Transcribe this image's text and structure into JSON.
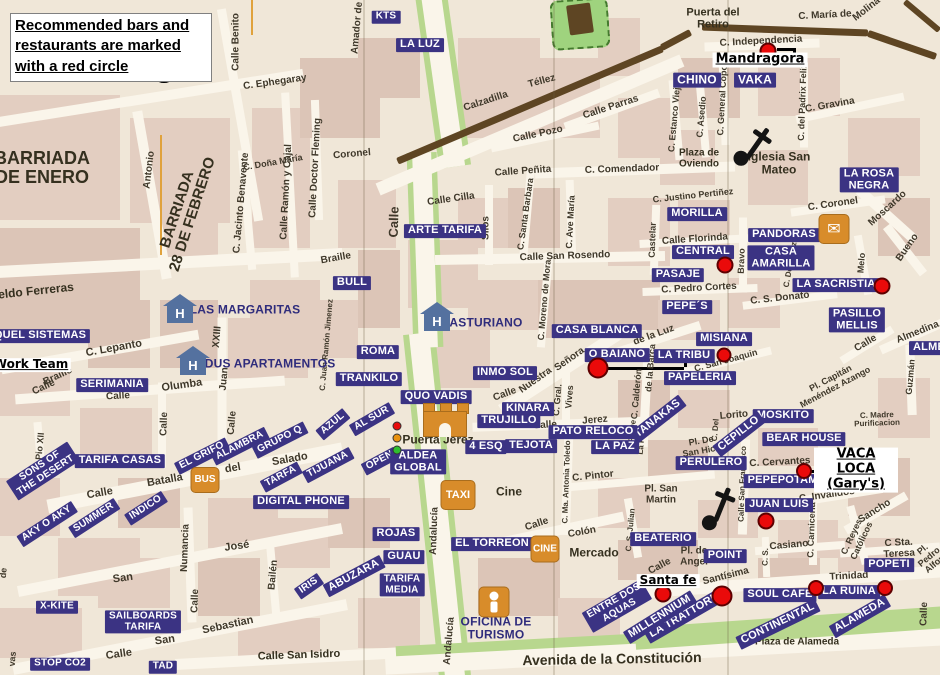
{
  "legend": {
    "line1": "Recommended bars and",
    "line2": "restaurants are marked",
    "line3": "with a red circle"
  },
  "colors": {
    "navy": "#3b3383",
    "red": "#ea0a0a",
    "orange": "#d88c2a",
    "wall": "#5e4523",
    "park": "#9fd37e",
    "road_green": "#b8d78e",
    "hotel_blue": "#54719f"
  },
  "shop_labels": [
    [
      "KTS",
      386,
      17,
      0,
      10
    ],
    [
      "LA LUZ",
      420,
      45,
      0,
      11
    ],
    [
      "ARTE TARIFA",
      445,
      231,
      0,
      11
    ],
    [
      "CHINO",
      697,
      80,
      0,
      12
    ],
    [
      "VAKA",
      755,
      80,
      0,
      12
    ],
    [
      "MORILLA",
      697,
      214,
      0,
      11
    ],
    [
      "PANDORAS",
      784,
      235,
      0,
      11
    ],
    [
      "CENTRAL",
      703,
      252,
      0,
      11
    ],
    [
      "CASA\nAMARILLA",
      781,
      258,
      0,
      11
    ],
    [
      "PASAJE",
      678,
      275,
      0,
      11
    ],
    [
      "LA ROSA\nNEGRA",
      869,
      180,
      0,
      11
    ],
    [
      "LA SACRISTIA",
      836,
      285,
      0,
      11
    ],
    [
      "PASILLO\nMELLIS",
      857,
      320,
      0,
      11
    ],
    [
      "PEPE´S",
      687,
      307,
      0,
      11
    ],
    [
      "CASA BLANCA",
      597,
      331,
      0,
      11
    ],
    [
      "O BAIANO",
      617,
      355,
      0,
      11
    ],
    [
      "LA TRIBU",
      684,
      356,
      0,
      11
    ],
    [
      "MISIANA",
      724,
      339,
      0,
      11
    ],
    [
      "PAPELERIA",
      700,
      378,
      0,
      11
    ],
    [
      "TANAKAS",
      658,
      419,
      -38,
      11
    ],
    [
      "MOSKITO",
      783,
      416,
      0,
      11
    ],
    [
      "BEAR HOUSE",
      804,
      439,
      0,
      11
    ],
    [
      "CEPILLO",
      739,
      434,
      -38,
      11
    ],
    [
      "PERULERO",
      711,
      463,
      0,
      11
    ],
    [
      "PEPEPOTAMO",
      787,
      481,
      0,
      11
    ],
    [
      "JUAN LUIS",
      779,
      505,
      0,
      11
    ],
    [
      "BEATERIO",
      663,
      539,
      0,
      11
    ],
    [
      "POINT",
      725,
      556,
      0,
      11
    ],
    [
      "POPETI",
      889,
      565,
      0,
      11
    ],
    [
      "SOUL CAFE",
      780,
      595,
      0,
      11
    ],
    [
      "LA RUINA",
      849,
      592,
      0,
      11
    ],
    [
      "ALAMEDA",
      860,
      616,
      -30,
      11
    ],
    [
      "CONTINENTAL",
      778,
      624,
      -26,
      11
    ],
    [
      "LA TRATTORIA",
      686,
      615,
      -30,
      11
    ],
    [
      "MILLENNIUM",
      660,
      617,
      -32,
      11
    ],
    [
      "ENTRE DOS\nAQUAS",
      617,
      606,
      -30,
      10
    ],
    [
      "EL TORREON",
      492,
      544,
      0,
      11
    ],
    [
      "ROJAS",
      396,
      534,
      0,
      11
    ],
    [
      "GUAU",
      404,
      557,
      0,
      11
    ],
    [
      "ABUZARA",
      354,
      576,
      -28,
      11
    ],
    [
      "TARIFA\nMEDIA",
      402,
      585,
      0,
      10
    ],
    [
      "IRIS",
      309,
      586,
      -35,
      10
    ],
    [
      "X-KITE",
      57,
      607,
      0,
      10
    ],
    [
      "SAILBOARDS\nTARIFA",
      143,
      622,
      0,
      10
    ],
    [
      "STOP CO2",
      60,
      664,
      0,
      10
    ],
    [
      "TAD",
      163,
      667,
      0,
      10
    ],
    [
      "INMO SOL",
      505,
      373,
      0,
      11
    ],
    [
      "KINARA",
      528,
      409,
      0,
      11
    ],
    [
      "TRUJILLO",
      509,
      421,
      0,
      11
    ],
    [
      "4 ESQ",
      486,
      447,
      0,
      11
    ],
    [
      "TEJOTA",
      531,
      446,
      0,
      11
    ],
    [
      "PATO RELOCO",
      593,
      432,
      0,
      11
    ],
    [
      "LA PAZ",
      615,
      447,
      0,
      11
    ],
    [
      "QUO VADIS",
      436,
      397,
      0,
      11
    ],
    [
      "ROMA",
      378,
      352,
      0,
      11
    ],
    [
      "TRANKILO",
      369,
      379,
      0,
      11
    ],
    [
      "BULL",
      352,
      283,
      0,
      11
    ],
    [
      "SERIMANIA",
      112,
      385,
      0,
      11
    ],
    [
      "QUEL SISTEMAS",
      40,
      336,
      0,
      11
    ],
    [
      "TARIFA CASAS",
      120,
      461,
      0,
      11
    ],
    [
      "SONS OF\nTHE DESERT",
      43,
      471,
      -33,
      10
    ],
    [
      "AKY O AKY",
      47,
      524,
      -33,
      10
    ],
    [
      "SUMMER",
      94,
      518,
      -33,
      10
    ],
    [
      "INDICO",
      146,
      508,
      -33,
      10
    ],
    [
      "EL GRIFO",
      202,
      456,
      -27,
      10
    ],
    [
      "ALAMBRA",
      240,
      446,
      -27,
      10
    ],
    [
      "GRUPO Q",
      280,
      440,
      -27,
      10
    ],
    [
      "AZUL",
      333,
      424,
      -40,
      10
    ],
    [
      "AL SUR",
      372,
      419,
      -30,
      10
    ],
    [
      "TIJUANA",
      328,
      465,
      -28,
      10
    ],
    [
      "OPEN",
      380,
      461,
      -28,
      10
    ],
    [
      "ALDEA\nGLOBAL",
      418,
      462,
      0,
      11
    ],
    [
      "DIGITAL PHONE",
      301,
      502,
      0,
      11
    ],
    [
      "TARFA",
      281,
      477,
      -28,
      10
    ],
    [
      "ALME",
      929,
      348,
      0,
      11
    ]
  ],
  "hotel_labels": [
    [
      "LAS MARGARITAS",
      245,
      310,
      0,
      12
    ],
    [
      "EDUS APARTAMENTOS",
      266,
      364,
      0,
      12
    ],
    [
      "ASTURIANO",
      486,
      323,
      0,
      12
    ],
    [
      "OFICINA DE\nTURISMO",
      496,
      628,
      0,
      12
    ]
  ],
  "area_labels": [
    [
      "BARRIADA\nDE ENERO",
      42,
      168,
      0,
      18
    ],
    [
      "BARRIADA\n28 DE FEBRERO",
      185,
      212,
      -72,
      15
    ],
    [
      "eldo Ferreras",
      36,
      291,
      -6,
      12
    ],
    [
      "Puerta del\nRetiro",
      713,
      19,
      0,
      11
    ],
    [
      "Plaza de\nOviendo",
      699,
      159,
      0,
      10
    ],
    [
      "Iglesia San\nMateo",
      779,
      163,
      0,
      12
    ],
    [
      "Puerta Jerez",
      438,
      440,
      0,
      12
    ],
    [
      "Cine",
      509,
      492,
      0,
      12
    ],
    [
      "Mercado",
      594,
      553,
      0,
      12
    ],
    [
      "Plaza de Alameda",
      797,
      643,
      0,
      10
    ],
    [
      "Avenida de la Constitución",
      612,
      659,
      -1,
      14
    ],
    [
      "Calle San Isidro",
      299,
      656,
      -2,
      11
    ]
  ],
  "street_labels": [
    [
      "Calle Benito",
      237,
      42,
      -90,
      10
    ],
    [
      "C. Ephegaray",
      275,
      83,
      -8,
      10
    ],
    [
      "Antonio",
      150,
      170,
      -83,
      10
    ],
    [
      "C. Jacinto Benavente",
      242,
      203,
      -85,
      10
    ],
    [
      "C. Doña María",
      273,
      163,
      -10,
      9
    ],
    [
      "Calle Ramón y Cajal",
      287,
      192,
      -87,
      10
    ],
    [
      "Calle Doctor Fleming",
      316,
      168,
      -87,
      10
    ],
    [
      "Coronel",
      352,
      155,
      -5,
      10
    ],
    [
      "Amador de",
      358,
      28,
      -85,
      10
    ],
    [
      "Calzadilla",
      486,
      102,
      -18,
      10
    ],
    [
      "Téllez",
      542,
      82,
      -15,
      10
    ],
    [
      "Calle Pozo",
      538,
      135,
      -12,
      10
    ],
    [
      "Calle Parras",
      611,
      108,
      -18,
      10
    ],
    [
      "Calle Peñita",
      523,
      172,
      -4,
      10
    ],
    [
      "C. Comendador",
      622,
      170,
      -2,
      10
    ],
    [
      "Calle Cilla",
      451,
      200,
      -8,
      10
    ],
    [
      "Silos",
      487,
      228,
      -90,
      10
    ],
    [
      "C. Santa Barbara",
      526,
      214,
      -82,
      9
    ],
    [
      "C. Ave María",
      571,
      222,
      -87,
      9
    ],
    [
      "Calle San Rosendo",
      565,
      257,
      -2,
      10
    ],
    [
      "C. Moreno de Mora",
      545,
      300,
      -85,
      9
    ],
    [
      "C. Justino Pertiñez",
      693,
      196,
      -6,
      9
    ],
    [
      "Calle Florinda",
      695,
      240,
      -4,
      10
    ],
    [
      "Castelar",
      653,
      240,
      -88,
      9
    ],
    [
      "Bravo",
      742,
      261,
      -88,
      9
    ],
    [
      "C. Pedro Cortes",
      699,
      289,
      -3,
      10
    ],
    [
      "C. S. Donato",
      780,
      299,
      -6,
      10
    ],
    [
      "C. Estanco Viejo",
      675,
      117,
      -85,
      9
    ],
    [
      "C. Asedio",
      702,
      117,
      -85,
      9
    ],
    [
      "C. General Copons",
      723,
      95,
      -87,
      9
    ],
    [
      "C. del Padrix Felix",
      803,
      102,
      -88,
      9
    ],
    [
      "C. Gravina",
      830,
      106,
      -10,
      10
    ],
    [
      "C. María de",
      825,
      16,
      -3,
      10
    ],
    [
      "Molina",
      867,
      10,
      -38,
      10
    ],
    [
      "C. Independencia",
      761,
      42,
      -3,
      10
    ],
    [
      "C. Coronel",
      833,
      205,
      -8,
      10
    ],
    [
      "Moscardo",
      888,
      209,
      -42,
      10
    ],
    [
      "Bueno",
      908,
      248,
      -55,
      10
    ],
    [
      "Melo",
      862,
      263,
      -85,
      9
    ],
    [
      "C. De los Azues",
      792,
      258,
      -80,
      8
    ],
    [
      "Almedina",
      918,
      333,
      -22,
      10
    ],
    [
      "Calle",
      866,
      344,
      -30,
      10
    ],
    [
      "Guzmán",
      911,
      377,
      -85,
      9
    ],
    [
      "Pl. Capitán\nMenéndez Azango",
      833,
      383,
      -28,
      9
    ],
    [
      "C. Madre Purificacion",
      877,
      420,
      -2,
      8
    ],
    [
      "de la Luz",
      654,
      336,
      -20,
      10
    ],
    [
      "Nuestra",
      536,
      381,
      -35,
      10
    ],
    [
      "Señora",
      570,
      360,
      -35,
      10
    ],
    [
      "C. Calderón",
      637,
      394,
      -85,
      9
    ],
    [
      "de la Barca",
      651,
      368,
      -85,
      9
    ],
    [
      "C. Gral.",
      558,
      400,
      -85,
      9
    ],
    [
      "Vives",
      570,
      397,
      -85,
      9
    ],
    [
      "Calle",
      505,
      395,
      -20,
      10
    ],
    [
      "Jerez",
      595,
      421,
      -5,
      10
    ],
    [
      "Calle",
      545,
      426,
      -3,
      10
    ],
    [
      "C. Del",
      716,
      430,
      -85,
      8
    ],
    [
      "Lorito",
      734,
      416,
      -5,
      10
    ],
    [
      "Pl. De\nSan Hicio",
      702,
      446,
      -10,
      9
    ],
    [
      "C. San Joaquin",
      726,
      361,
      -15,
      9
    ],
    [
      "C. Cervantes",
      780,
      463,
      -3,
      10
    ],
    [
      "C. Invalidos",
      827,
      496,
      -8,
      10
    ],
    [
      "Sancho",
      875,
      512,
      -32,
      10
    ],
    [
      "C. Carniceria",
      812,
      530,
      -88,
      9
    ],
    [
      "Casiano",
      789,
      546,
      -5,
      10
    ],
    [
      "C. Reyes",
      852,
      537,
      -65,
      9
    ],
    [
      "Católicos",
      862,
      541,
      -65,
      9
    ],
    [
      "C Sta. Teresa",
      899,
      549,
      -3,
      10
    ],
    [
      "Pl. Pedro Alfon",
      929,
      557,
      -40,
      9
    ],
    [
      "Trinidad",
      849,
      577,
      -3,
      10
    ],
    [
      "Santísima",
      726,
      577,
      -14,
      10
    ],
    [
      "Calle",
      660,
      567,
      -28,
      10
    ],
    [
      "Pl. de\nAngel",
      694,
      557,
      0,
      10
    ],
    [
      "Calle",
      925,
      614,
      -88,
      10
    ],
    [
      "Calle",
      537,
      525,
      -18,
      10
    ],
    [
      "Colón",
      582,
      533,
      -10,
      10
    ],
    [
      "C. Ma. Antonia Toledo",
      567,
      482,
      -88,
      8
    ],
    [
      "C. S. Julian",
      631,
      530,
      -85,
      8
    ],
    [
      "C. Pintor",
      593,
      477,
      -6,
      10
    ],
    [
      "Pl. San\nMartin",
      661,
      495,
      0,
      10
    ],
    [
      "Calle San Francisco",
      743,
      484,
      -88,
      8
    ],
    [
      "C. S.",
      766,
      557,
      -88,
      8
    ],
    [
      "Braille",
      336,
      259,
      -10,
      10
    ],
    [
      "Calle",
      394,
      222,
      -88,
      13
    ],
    [
      "Braille",
      58,
      377,
      -25,
      10
    ],
    [
      "Calle",
      44,
      388,
      -25,
      10
    ],
    [
      "C. Lepanto",
      114,
      349,
      -10,
      11
    ],
    [
      "Olumba",
      182,
      386,
      -8,
      11
    ],
    [
      "Calle",
      118,
      397,
      -3,
      10
    ],
    [
      "Calle",
      165,
      424,
      -88,
      10
    ],
    [
      "XXIII",
      218,
      337,
      -85,
      10
    ],
    [
      "Juan",
      225,
      379,
      -85,
      10
    ],
    [
      "Calle",
      233,
      423,
      -85,
      10
    ],
    [
      "C. Pio XII",
      40,
      452,
      -85,
      9
    ],
    [
      "Calle",
      100,
      494,
      -10,
      11
    ],
    [
      "Batalla",
      165,
      481,
      -10,
      11
    ],
    [
      "del",
      233,
      469,
      -10,
      11
    ],
    [
      "Salado",
      290,
      460,
      -10,
      11
    ],
    [
      "Numancia",
      186,
      548,
      -88,
      10
    ],
    [
      "Calle",
      196,
      601,
      -88,
      10
    ],
    [
      "José",
      237,
      547,
      -8,
      11
    ],
    [
      "San",
      123,
      579,
      -8,
      11
    ],
    [
      "Bailén",
      274,
      575,
      -85,
      10
    ],
    [
      "San",
      165,
      641,
      -8,
      11
    ],
    [
      "Sebastian",
      228,
      626,
      -12,
      11
    ],
    [
      "Calle",
      119,
      655,
      -8,
      11
    ],
    [
      "Andalucía",
      435,
      531,
      -88,
      10
    ],
    [
      "Andalucía",
      450,
      641,
      -85,
      10
    ],
    [
      "C. Juan Ramón Jimenez",
      327,
      345,
      -85,
      8
    ],
    [
      "Pl. De",
      633,
      431,
      -85,
      8
    ],
    [
      "La Paz",
      642,
      442,
      -85,
      8
    ],
    [
      "IV",
      848,
      451,
      -88,
      8
    ],
    [
      "de",
      4,
      573,
      -85,
      9
    ],
    [
      "vas",
      13,
      659,
      -85,
      9
    ]
  ],
  "annotations": [
    [
      "Mandragora",
      760,
      60,
      13
    ],
    [
      "Work Team",
      31,
      365,
      12
    ],
    [
      "VACA LOCA\n(Gary's)",
      856,
      470,
      13
    ],
    [
      "Santa fe",
      668,
      581,
      12
    ]
  ],
  "red_circles": [
    [
      164,
      70,
      26,
      1
    ],
    [
      768,
      51,
      17,
      0
    ],
    [
      725,
      265,
      17,
      0
    ],
    [
      882,
      286,
      17,
      0
    ],
    [
      724,
      355,
      15,
      0
    ],
    [
      598,
      368,
      21,
      0
    ],
    [
      804,
      471,
      16,
      0
    ],
    [
      766,
      521,
      17,
      0
    ],
    [
      663,
      594,
      17,
      0
    ],
    [
      722,
      596,
      21,
      0
    ],
    [
      816,
      588,
      16,
      0
    ],
    [
      885,
      588,
      16,
      0
    ]
  ],
  "icons": {
    "hotels": [
      [
        180,
        309
      ],
      [
        193,
        361
      ],
      [
        437,
        317
      ]
    ],
    "transport": [
      [
        "BUS",
        205,
        480,
        27,
        24,
        10
      ],
      [
        "TAXI",
        458,
        495,
        33,
        28,
        11
      ],
      [
        "CINE",
        545,
        549,
        27,
        25,
        10
      ]
    ],
    "churches": [
      [
        753,
        149,
        35
      ],
      [
        719,
        511,
        22
      ]
    ],
    "envelope": [
      834,
      229
    ],
    "envelope_glyph": "✉",
    "tourism": [
      494,
      602
    ],
    "castle": [
      445,
      420
    ],
    "traffic_light": [
      397,
      426
    ]
  },
  "connectors": [
    [
      605,
      367,
      684,
      367
    ],
    [
      684,
      359,
      684,
      367
    ],
    [
      777,
      48,
      793,
      48
    ],
    [
      793,
      48,
      793,
      60
    ],
    [
      810,
      470,
      822,
      470
    ]
  ]
}
